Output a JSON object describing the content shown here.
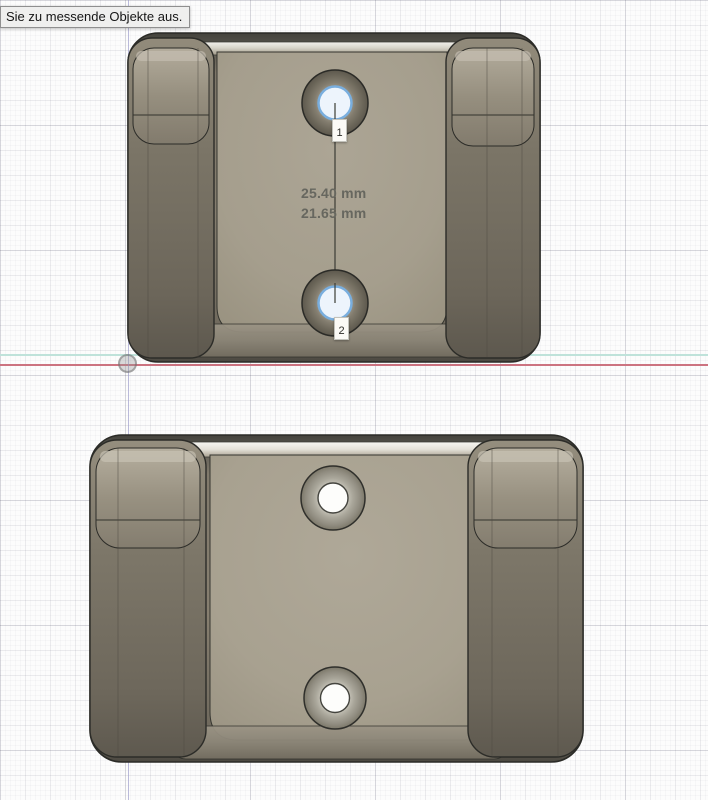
{
  "app": {
    "name": "CAD measure tool viewport",
    "tooltip_text": "Sie zu messende Objekte aus."
  },
  "measurement": {
    "line1": "25.40 mm",
    "line2": "21.65 mm"
  },
  "markers": {
    "point1": "1",
    "point2": "2"
  },
  "colors": {
    "axis_red": "#cc7380",
    "axis_teal": "#bfe2da",
    "axis_vertical": "#b5b5d4",
    "selection_blue": "#79aede",
    "body_tan": "#a9a292",
    "rail_dark": "#716b5f",
    "outline": "#2b2b27",
    "grid_bg": "#fcfcfc"
  }
}
